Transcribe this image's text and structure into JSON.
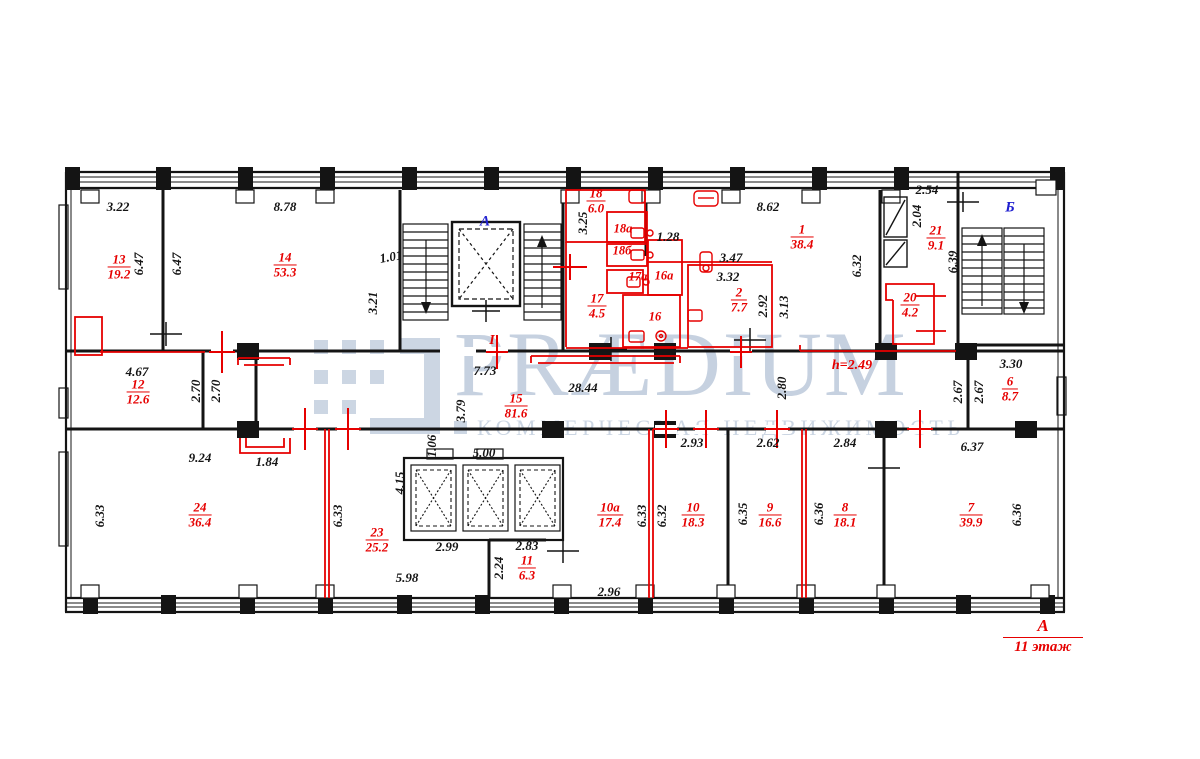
{
  "colors": {
    "red": "#e60000",
    "blue": "#2020d0",
    "line": "#141414",
    "watermark": "#c6d1e0"
  },
  "watermark": {
    "brand": "PRÆDIUM",
    "tagline": "КОММЕРЧЕСКАЯ НЕДВИЖИМОСТЬ"
  },
  "legend": {
    "axis": "А",
    "floor": "11 этаж"
  },
  "rooms": [
    {
      "num": "13",
      "area": "19.2",
      "x": 119,
      "y": 267
    },
    {
      "num": "14",
      "area": "53.3",
      "x": 285,
      "y": 265
    },
    {
      "num": "18",
      "area": "6.0",
      "x": 596,
      "y": 201
    },
    {
      "num": "17",
      "area": "4.5",
      "x": 597,
      "y": 306
    },
    {
      "num": "1",
      "area": "38.4",
      "x": 802,
      "y": 237
    },
    {
      "num": "2",
      "area": "7.7",
      "x": 739,
      "y": 300
    },
    {
      "num": "21",
      "area": "9.1",
      "x": 936,
      "y": 238
    },
    {
      "num": "20",
      "area": "4.2",
      "x": 910,
      "y": 305
    },
    {
      "num": "6",
      "area": "8.7",
      "x": 1010,
      "y": 389
    },
    {
      "num": "12",
      "area": "12.6",
      "x": 138,
      "y": 392
    },
    {
      "num": "15",
      "area": "81.6",
      "x": 516,
      "y": 406
    },
    {
      "num": "24",
      "area": "36.4",
      "x": 200,
      "y": 515
    },
    {
      "num": "23",
      "area": "25.2",
      "x": 377,
      "y": 540
    },
    {
      "num": "11",
      "area": "6.3",
      "x": 527,
      "y": 568
    },
    {
      "num": "10а",
      "area": "17.4",
      "x": 610,
      "y": 515
    },
    {
      "num": "10",
      "area": "18.3",
      "x": 693,
      "y": 515
    },
    {
      "num": "9",
      "area": "16.6",
      "x": 770,
      "y": 515
    },
    {
      "num": "8",
      "area": "18.1",
      "x": 845,
      "y": 515
    },
    {
      "num": "7",
      "area": "39.9",
      "x": 971,
      "y": 515
    }
  ],
  "texts": [
    {
      "t": "3.22",
      "x": 118,
      "y": 207,
      "r": 0,
      "c": "dim"
    },
    {
      "t": "8.78",
      "x": 285,
      "y": 207,
      "r": 0,
      "c": "dim"
    },
    {
      "t": "6.47",
      "x": 139,
      "y": 264,
      "r": -90,
      "c": "dim"
    },
    {
      "t": "6.47",
      "x": 177,
      "y": 264,
      "r": -90,
      "c": "dim"
    },
    {
      "t": "1.01",
      "x": 391,
      "y": 257,
      "r": -10,
      "c": "dim"
    },
    {
      "t": "3.21",
      "x": 373,
      "y": 303,
      "r": -90,
      "c": "dim"
    },
    {
      "t": "3.25",
      "x": 583,
      "y": 223,
      "r": -90,
      "c": "dim"
    },
    {
      "t": "1.28",
      "x": 668,
      "y": 237,
      "r": 0,
      "c": "dim"
    },
    {
      "t": "8.62",
      "x": 768,
      "y": 207,
      "r": 0,
      "c": "dim"
    },
    {
      "t": "3.47",
      "x": 731,
      "y": 258,
      "r": 0,
      "c": "dim"
    },
    {
      "t": "3.32",
      "x": 728,
      "y": 277,
      "r": 0,
      "c": "dim"
    },
    {
      "t": "2.92",
      "x": 763,
      "y": 306,
      "r": -90,
      "c": "dim"
    },
    {
      "t": "3.13",
      "x": 784,
      "y": 307,
      "r": -90,
      "c": "dim"
    },
    {
      "t": "6.32",
      "x": 857,
      "y": 266,
      "r": -90,
      "c": "dim"
    },
    {
      "t": "2.54",
      "x": 927,
      "y": 190,
      "r": 0,
      "c": "dim"
    },
    {
      "t": "2.04",
      "x": 917,
      "y": 216,
      "r": -90,
      "c": "dim"
    },
    {
      "t": "6.39",
      "x": 953,
      "y": 262,
      "r": -90,
      "c": "dim"
    },
    {
      "t": "3.30",
      "x": 1011,
      "y": 364,
      "r": 0,
      "c": "dim"
    },
    {
      "t": "2.67",
      "x": 958,
      "y": 392,
      "r": -90,
      "c": "dim"
    },
    {
      "t": "2.67",
      "x": 979,
      "y": 392,
      "r": -90,
      "c": "dim"
    },
    {
      "t": "4.67",
      "x": 137,
      "y": 372,
      "r": 0,
      "c": "dim"
    },
    {
      "t": "2.70",
      "x": 196,
      "y": 391,
      "r": -90,
      "c": "dim"
    },
    {
      "t": "2.70",
      "x": 216,
      "y": 391,
      "r": -90,
      "c": "dim"
    },
    {
      "t": "7.73",
      "x": 485,
      "y": 371,
      "r": 0,
      "c": "dim"
    },
    {
      "t": "28.44",
      "x": 583,
      "y": 388,
      "r": 0,
      "c": "dim"
    },
    {
      "t": "3.79",
      "x": 461,
      "y": 411,
      "r": -90,
      "c": "dim"
    },
    {
      "t": "2.80",
      "x": 782,
      "y": 388,
      "r": -90,
      "c": "dim"
    },
    {
      "t": "9.24",
      "x": 200,
      "y": 458,
      "r": 0,
      "c": "dim"
    },
    {
      "t": "1.84",
      "x": 267,
      "y": 462,
      "r": 0,
      "c": "dim"
    },
    {
      "t": "1.06",
      "x": 432,
      "y": 446,
      "r": -90,
      "c": "dim"
    },
    {
      "t": "4.15",
      "x": 400,
      "y": 483,
      "r": -90,
      "c": "dim"
    },
    {
      "t": "5.00",
      "x": 484,
      "y": 453,
      "r": 0,
      "c": "dim"
    },
    {
      "t": "2.99",
      "x": 447,
      "y": 547,
      "r": 0,
      "c": "dim"
    },
    {
      "t": "2.83",
      "x": 527,
      "y": 546,
      "r": 0,
      "c": "dim"
    },
    {
      "t": "2.24",
      "x": 499,
      "y": 568,
      "r": -90,
      "c": "dim"
    },
    {
      "t": "5.98",
      "x": 407,
      "y": 578,
      "r": 0,
      "c": "dim"
    },
    {
      "t": "2.96",
      "x": 609,
      "y": 592,
      "r": 0,
      "c": "dim"
    },
    {
      "t": "2.93",
      "x": 692,
      "y": 443,
      "r": 0,
      "c": "dim"
    },
    {
      "t": "2.62",
      "x": 768,
      "y": 443,
      "r": 0,
      "c": "dim"
    },
    {
      "t": "2.84",
      "x": 845,
      "y": 443,
      "r": 0,
      "c": "dim"
    },
    {
      "t": "6.37",
      "x": 972,
      "y": 447,
      "r": 0,
      "c": "dim"
    },
    {
      "t": "6.33",
      "x": 100,
      "y": 516,
      "r": -90,
      "c": "dim"
    },
    {
      "t": "6.33",
      "x": 338,
      "y": 516,
      "r": -90,
      "c": "dim"
    },
    {
      "t": "6.33",
      "x": 642,
      "y": 516,
      "r": -90,
      "c": "dim"
    },
    {
      "t": "6.32",
      "x": 662,
      "y": 516,
      "r": -90,
      "c": "dim"
    },
    {
      "t": "6.35",
      "x": 743,
      "y": 514,
      "r": -90,
      "c": "dim"
    },
    {
      "t": "6.36",
      "x": 819,
      "y": 514,
      "r": -90,
      "c": "dim"
    },
    {
      "t": "6.36",
      "x": 1017,
      "y": 515,
      "r": -90,
      "c": "dim"
    },
    {
      "t": "18а",
      "x": 623,
      "y": 229,
      "r": 0,
      "c": "tag"
    },
    {
      "t": "18б",
      "x": 622,
      "y": 251,
      "r": 0,
      "c": "tag"
    },
    {
      "t": "17а",
      "x": 638,
      "y": 277,
      "r": 0,
      "c": "tag"
    },
    {
      "t": "16а",
      "x": 664,
      "y": 276,
      "r": 0,
      "c": "tag"
    },
    {
      "t": "16",
      "x": 655,
      "y": 317,
      "r": 0,
      "c": "tag"
    },
    {
      "t": "А",
      "x": 485,
      "y": 222,
      "r": 0,
      "c": "axis"
    },
    {
      "t": "Б",
      "x": 1010,
      "y": 208,
      "r": 0,
      "c": "axis"
    },
    {
      "t": "I",
      "x": 492,
      "y": 341,
      "r": 0,
      "c": "red"
    },
    {
      "t": "h=2.49",
      "x": 852,
      "y": 366,
      "r": 0,
      "c": "red"
    }
  ]
}
